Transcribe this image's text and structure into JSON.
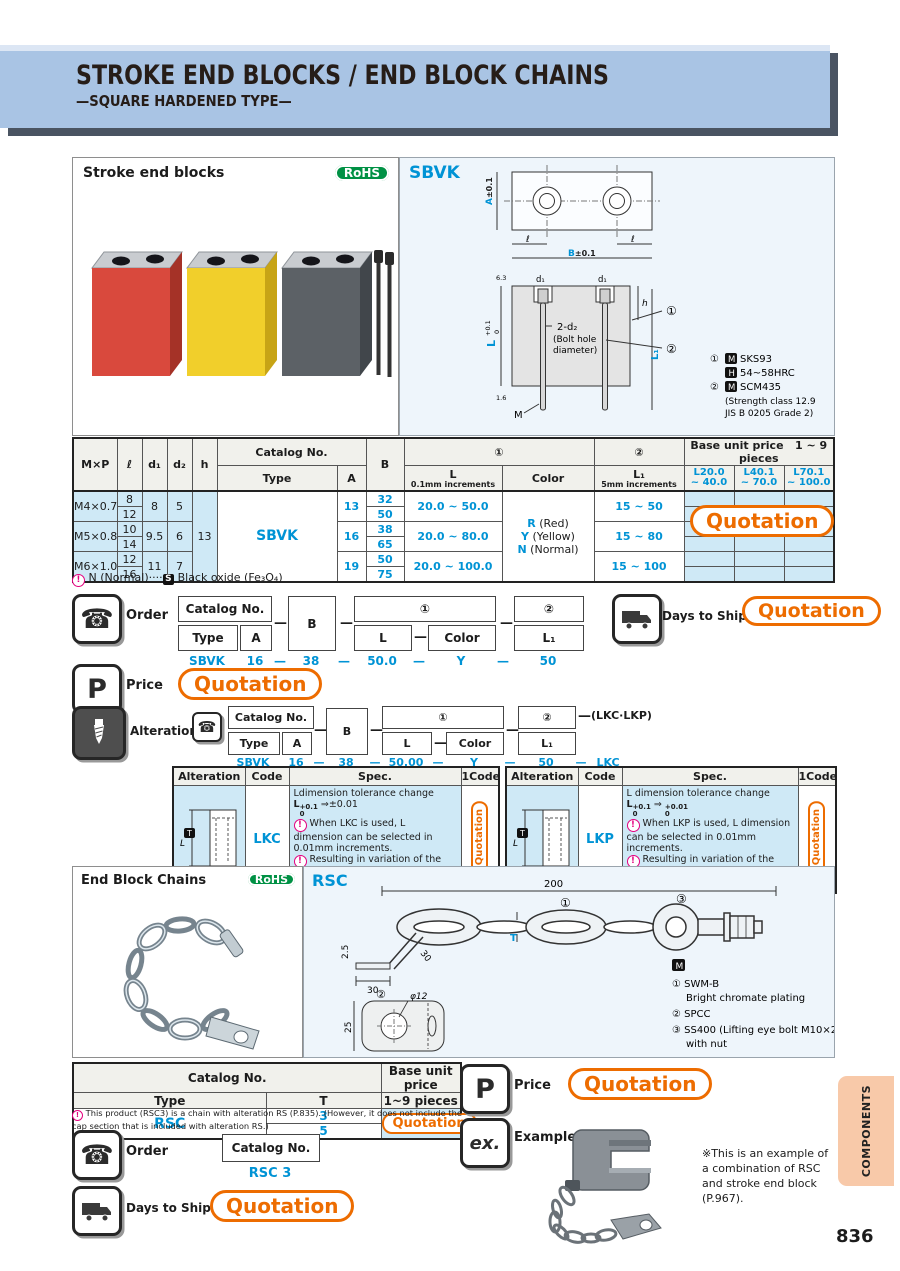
{
  "header": {
    "title": "STROKE END BLOCKS / END BLOCK CHAINS",
    "subtitle": "—SQUARE HARDENED TYPE—"
  },
  "page": {
    "number": "836",
    "side_tab": "COMPONENTS"
  },
  "icons": {
    "phone": "☎"
  },
  "photo_blocks": {
    "label": "Stroke end blocks",
    "rohs": "RoHS"
  },
  "sbvk": {
    "code": "SBVK",
    "dims": {
      "a": "A",
      "a_tol": "±0.1",
      "b": "B",
      "b_tol": "±0.1",
      "ell_left": "ℓ",
      "ell_right": "ℓ",
      "d1_left": "d₁",
      "d1_right": "d₁",
      "h": "h",
      "L": "L",
      "L_tol_top": "+0.1",
      "L_tol_bot": "0",
      "L1": "L₁",
      "bolt1": "2-d₂",
      "bolt2": "(Bolt hole",
      "bolt3": "diameter)",
      "m": "M",
      "ref1": "①",
      "ref2": "②",
      "rough1": "6.3",
      "rough2": "1.6"
    },
    "notes": {
      "r1_ref": "①",
      "r1_icon": "M",
      "r1_text": "SKS93",
      "r2_icon": "H",
      "r2_text": "54~58HRC",
      "r3_ref": "②",
      "r3_icon": "M",
      "r3_text": "SCM435",
      "r4": "(Strength class 12.9",
      "r5": " JIS B 0205 Grade 2)"
    }
  },
  "main_table": {
    "h_mxp": "M×P",
    "h_l": "ℓ",
    "h_d1": "d₁",
    "h_d2": "d₂",
    "h_h": "h",
    "h_catalog": "Catalog No.",
    "h_type": "Type",
    "h_a": "A",
    "h_b": "B",
    "h_c1": "①",
    "h_L": "L",
    "h_L_inc": "0.1mm increments",
    "h_color": "Color",
    "h_c2": "②",
    "h_L1": "L₁",
    "h_L1_inc": "5mm increments",
    "h_price": "Base unit price",
    "h_pieces": "1 ~ 9 pieces",
    "price_cols": [
      {
        "top": "L20.0",
        "bot": "~ 40.0"
      },
      {
        "top": "L40.1",
        "bot": "~ 70.0"
      },
      {
        "top": "L70.1",
        "bot": "~ 100.0"
      }
    ],
    "type_value": "SBVK",
    "h_value": "13",
    "colors": [
      {
        "code": "R",
        "name": "(Red)"
      },
      {
        "code": "Y",
        "name": "(Yellow)"
      },
      {
        "code": "N",
        "name": "(Normal)"
      }
    ],
    "groups": [
      {
        "mxp": "M4×0.7",
        "l1": "8",
        "l2": "12",
        "d1": "8",
        "d2": "5",
        "a": "13",
        "b1": "32",
        "b2": "50",
        "L": "20.0 ~  50.0",
        "L1": "15 ~  50"
      },
      {
        "mxp": "M5×0.8",
        "l1": "10",
        "l2": "14",
        "d1": "9.5",
        "d2": "6",
        "a": "16",
        "b1": "38",
        "b2": "65",
        "L": "20.0 ~  80.0",
        "L1": "15 ~  80"
      },
      {
        "mxp": "M6×1.0",
        "l1": "12",
        "l2": "16",
        "d1": "11",
        "d2": "7",
        "a": "19",
        "b1": "50",
        "b2": "75",
        "L": "20.0 ~ 100.0",
        "L1": "15 ~ 100"
      }
    ],
    "quotation": "Quotation",
    "caution_mark": "!",
    "footnote_pre": "N (Normal)",
    "footnote_dots": "····",
    "footnote_s": "S",
    "footnote_post": "Black oxide (Fe₃O₄)"
  },
  "order": {
    "label": "Order",
    "catalog_no": "Catalog No.",
    "type": "Type",
    "a": "A",
    "b": "B",
    "c1": "①",
    "l": "L",
    "color": "Color",
    "c2": "②",
    "l1": "L₁",
    "dash": "—",
    "ex_type": "SBVK",
    "ex_a": "16",
    "ex_b": "38",
    "ex_l": "50.0",
    "ex_color": "Y",
    "ex_l1": "50"
  },
  "ship": {
    "label": "Days to Ship",
    "quotation": "Quotation"
  },
  "price": {
    "label": "Price",
    "icon": "P",
    "quotation": "Quotation"
  },
  "alter": {
    "label": "Alterations",
    "catalog_no": "Catalog No.",
    "type": "Type",
    "a": "A",
    "b": "B",
    "c1": "①",
    "l": "L",
    "color": "Color",
    "c2": "②",
    "l1": "L₁",
    "dash": "—",
    "suffix": "(LKC·LKP)",
    "ex_type": "SBVK",
    "ex_a": "16",
    "ex_b": "38",
    "ex_l": "50.00",
    "ex_color": "Y",
    "ex_l1": "50",
    "ex_code": "LKC"
  },
  "alt_tables": {
    "h_alteration": "Alteration",
    "h_code": "Code",
    "h_spec": "Spec.",
    "h_1code": "1Code",
    "diagram_l": "L",
    "diagram_t": "T",
    "lkc": {
      "code": "LKC",
      "line1": "Ldimension tolerance change",
      "l": "L",
      "tol_top": "+0.1",
      "tol_bot": "0",
      "arrow": "⇒",
      "res": "±0.01",
      "b1": "When LKC is used, L dimension can be selected in 0.01mm increments.",
      "b2": "Resulting in variation of the finished L dimension of 0.005 or less.",
      "quotation": "Quotation"
    },
    "lkp": {
      "code": "LKP",
      "line1": "L dimension tolerance change",
      "l": "L",
      "tol_top": "+0.1",
      "tol_bot": "0",
      "arrow": "⇒",
      "res_top": "+0.01",
      "res_bot": "0",
      "b1": "When LKP is used, L dimension can be selected in 0.01mm increments.",
      "b2": "Resulting in variation of the finished L dimension of 0.005 or less.",
      "quotation": "Quotation"
    }
  },
  "chains_photo": {
    "label": "End Block Chains",
    "rohs": "RoHS"
  },
  "rsc": {
    "code": "RSC",
    "dims": {
      "d200": "200",
      "t": "T",
      "d2_5": "2.5",
      "d30a": "30",
      "d30b": "30",
      "phi": "φ12",
      "d25": "25",
      "ref1": "①",
      "ref2": "②",
      "ref3": "③"
    },
    "notes": {
      "m_icon": "M",
      "n1_ref": "①",
      "n1": "SWM-B",
      "n1b": "Bright chromate plating",
      "n2_ref": "②",
      "n2": "SPCC",
      "n3_ref": "③",
      "n3": "SS400 (Lifting eye bolt M10×20)",
      "n3b": "with nut"
    }
  },
  "rsc_table": {
    "h_catalog": "Catalog No.",
    "h_type": "Type",
    "h_t": "T",
    "h_price": "Base unit price",
    "h_pieces": "1~9 pieces",
    "type": "RSC",
    "t1": "3",
    "t2": "5",
    "quotation": "Quotation",
    "footnote": "This product (RSC3) is a chain with alteration RS (P.835). (However, it does not include the cap section that is included with alteration RS.)"
  },
  "rsc_order": {
    "label": "Order",
    "catalog_no": "Catalog No.",
    "example": "RSC 3"
  },
  "rsc_ship": {
    "label": "Days to Ship",
    "quotation": "Quotation"
  },
  "rsc_price": {
    "label": "Price",
    "icon": "P",
    "quotation": "Quotation"
  },
  "example": {
    "icon": "ex.",
    "label": "Example",
    "note": "※This is an example of a combination of RSC and stroke end block (P.967)."
  }
}
